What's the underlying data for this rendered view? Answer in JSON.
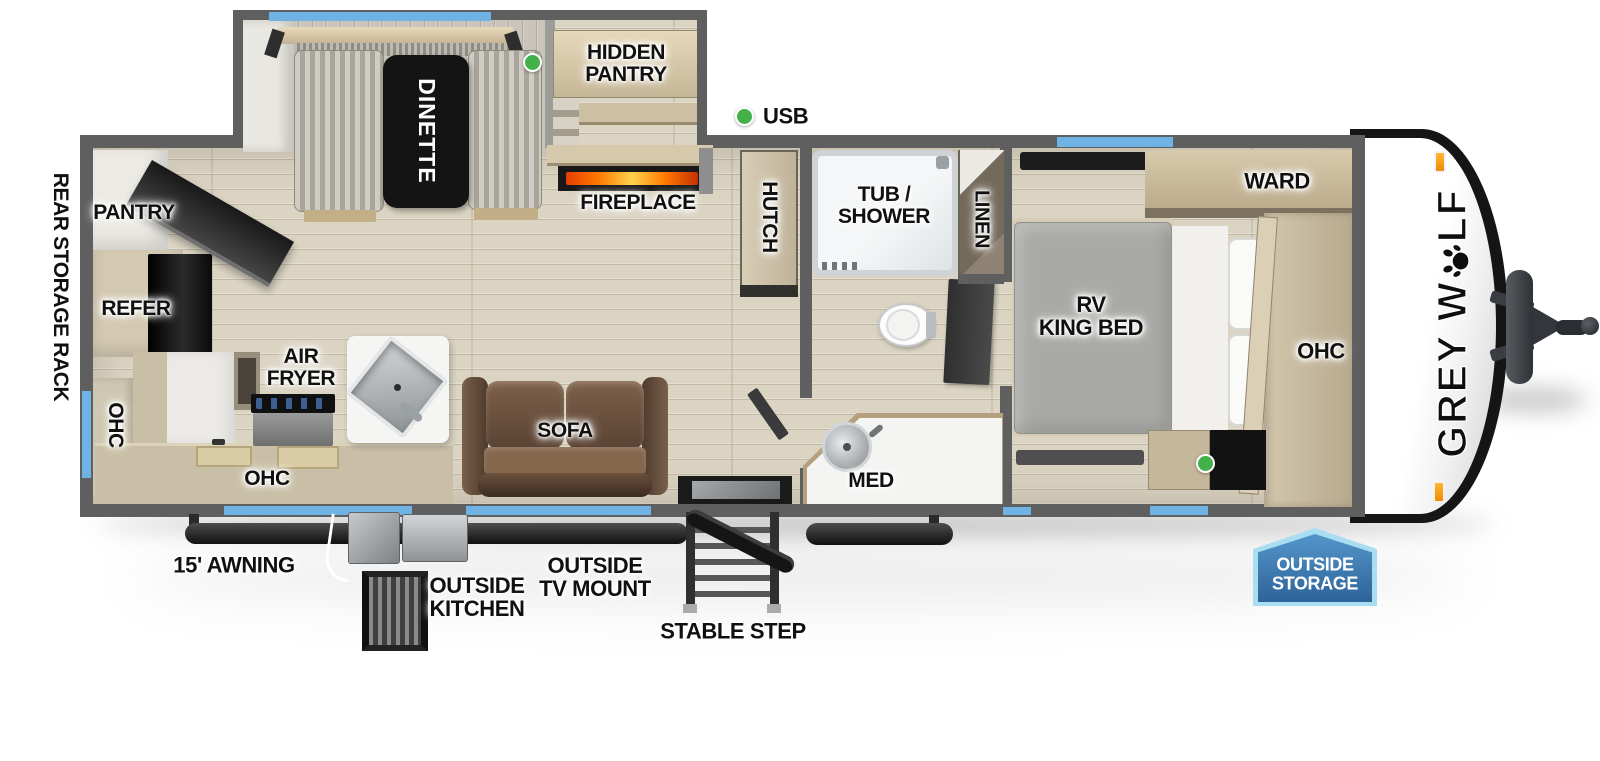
{
  "brand": {
    "prefix": "GREY W",
    "suffix": "LF"
  },
  "legend": {
    "usb": "USB"
  },
  "exterior": {
    "rear_storage_rack": "REAR STORAGE RACK",
    "awning": "15' AWNING",
    "outside_kitchen": "OUTSIDE\nKITCHEN",
    "outside_tv_mount": "OUTSIDE\nTV MOUNT",
    "stable_step": "STABLE STEP",
    "outside_storage": "OUTSIDE\nSTORAGE"
  },
  "rooms": {
    "kitchen": {
      "pantry": "PANTRY",
      "refer": "REFER",
      "ohc_rear": "OHC",
      "ohc_counter": "OHC",
      "air_fryer": "AIR\nFRYER"
    },
    "living": {
      "dinette": "DINETTE",
      "hidden_pantry": "HIDDEN\nPANTRY",
      "fireplace": "FIREPLACE",
      "sofa": "SOFA",
      "hutch": "HUTCH"
    },
    "bathroom": {
      "tub_shower": "TUB /\nSHOWER",
      "linen": "LINEN",
      "med": "MED"
    },
    "bedroom": {
      "rv_king_bed": "RV\nKING BED",
      "ward": "WARD",
      "ohc": "OHC"
    }
  },
  "colors": {
    "accent_blue": "#6fb3e4",
    "usb_green": "#44b04a",
    "flame_orange": "#ff7a00",
    "badge_fill": "#2e6399",
    "badge_border": "#a9ddf1",
    "wall_gray": "#5f5f5f",
    "brand_black": "#0e0e0e"
  }
}
